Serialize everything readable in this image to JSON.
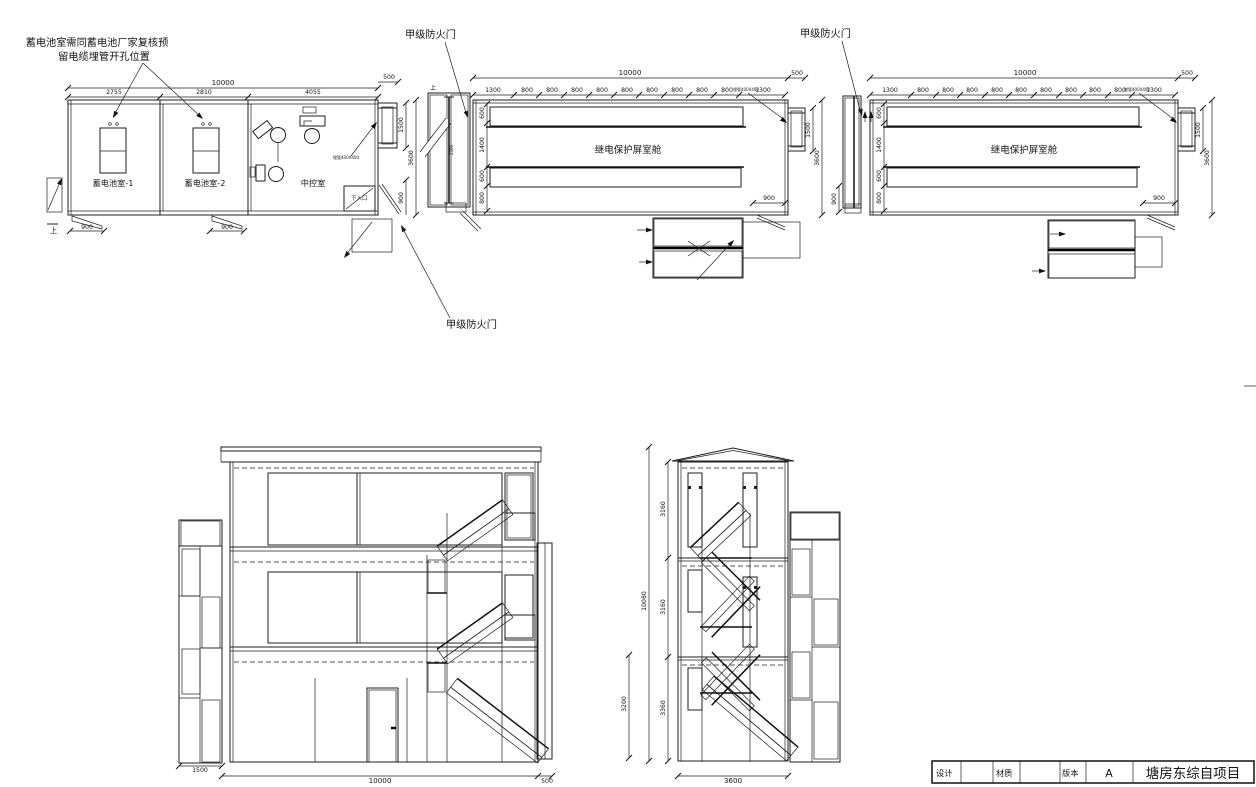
{
  "annotations": {
    "battery_note_1": "蓄电池室需同蓄电池厂家复核预",
    "battery_note_2": "留电缆埋管开孔位置",
    "fire_door_1": "甲级防火门",
    "fire_door_2": "甲级防火门",
    "fire_door_3": "甲级防火门",
    "pipe_note_1": "埋管400X400",
    "pipe_note_2": "埋管400X400",
    "pipe_note_3": "埋管400X400",
    "up_1": "上",
    "up_2": "上"
  },
  "plan1": {
    "rooms": {
      "battery1": "蓄电池室-1",
      "battery2": "蓄电池室-2",
      "control": "中控室"
    },
    "entry_box": "下入口",
    "dims": {
      "total": "10000",
      "ext": "500",
      "seg1": "2755",
      "seg2": "2810",
      "seg3": "4055",
      "ladder_h": "1500",
      "depth": "3600",
      "door": "900",
      "stair1": "900",
      "stair2": "900"
    }
  },
  "plan2": {
    "room": "继电保护屏室舱",
    "stair_width": "2500",
    "dims": {
      "total": "10000",
      "ext": "500",
      "end_l": "1300",
      "end_r": "1300",
      "mid": [
        "800",
        "800",
        "800",
        "800",
        "800",
        "800",
        "800",
        "800",
        "800"
      ],
      "left": [
        "600",
        "1400",
        "600",
        "800"
      ],
      "ladder_h": "1500",
      "depth": "3600",
      "door": "900"
    }
  },
  "plan3": {
    "room": "继电保护屏室舱",
    "dims": {
      "total": "10000",
      "ext": "500",
      "end_l": "1300",
      "end_r": "1300",
      "mid": [
        "800",
        "800",
        "800",
        "800",
        "800",
        "800",
        "800",
        "800",
        "800"
      ],
      "left": [
        "600",
        "1400",
        "600",
        "800"
      ],
      "ladder_h": "1500",
      "depth": "3600",
      "door": "900",
      "side": "900"
    }
  },
  "elev_front": {
    "dims": {
      "left": "1500",
      "main": "10000",
      "right": "500"
    }
  },
  "elev_side": {
    "dims": {
      "floor_top": "3160",
      "floor_mid": "3160",
      "floor_bot": "3360",
      "total": "10080",
      "lower": "3200",
      "width": "3600"
    }
  },
  "title_block": {
    "design": "设计",
    "material": "材质",
    "version_label": "版本",
    "version": "A",
    "project": "塘房东综自项目"
  }
}
